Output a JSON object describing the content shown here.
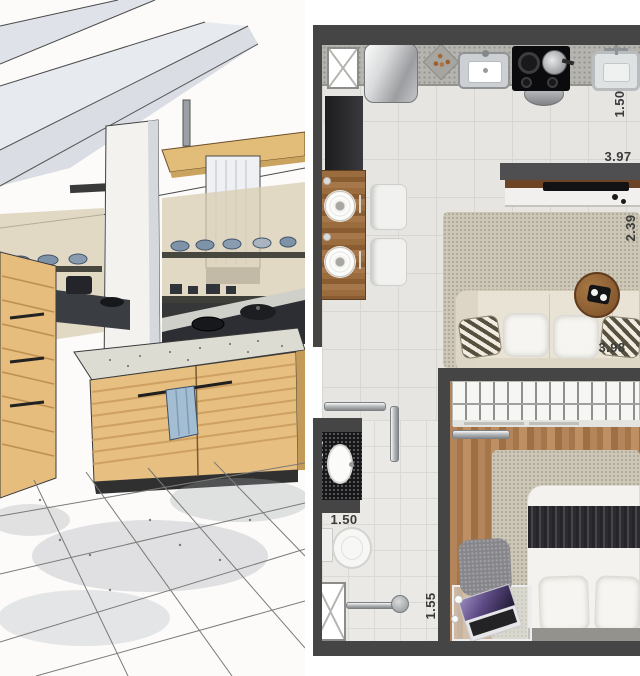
{
  "panels": {
    "left": "kitchen-interior-marker-sketch",
    "right": "studio-apartment-floor-plan-top-view"
  },
  "floor_plan": {
    "dimensions": {
      "kitchen_depth": "1.50",
      "living_width": "3.97",
      "living_depth": "2.39",
      "bedroom_width": "3.98",
      "bathroom_width": "1.50",
      "shower_width": "1.55"
    },
    "rooms": [
      "kitchen",
      "dining",
      "living",
      "hall",
      "bathroom",
      "bedroom"
    ],
    "objects": {
      "kitchen": [
        "ventilation-shaft",
        "refrigerator",
        "decor-dish",
        "sink",
        "cooktop",
        "service-sink",
        "hanging-pot"
      ],
      "dining": [
        "wood-counter-table",
        "place-settings",
        "white-chairs"
      ],
      "living": [
        "tv-panel",
        "media-console",
        "area-rug",
        "sofa",
        "striped-pillows",
        "round-side-table"
      ],
      "bathroom": [
        "granite-vanity",
        "oval-sink",
        "toilet",
        "shower-head",
        "ventilation-shaft"
      ],
      "bedroom": [
        "wardrobe-with-hangers",
        "double-bed",
        "pillows",
        "striped-runner",
        "area-rug",
        "glass-desk",
        "laptop",
        "desk-chair",
        "sliding-door"
      ]
    },
    "colors": {
      "wall": "#454545",
      "floor_tile": "#e6e5e2",
      "wood_floor": "#ad7c4e",
      "counter": "#b5b4ae",
      "rug": "#cdc7b7",
      "granite": "#17171a"
    }
  },
  "sketch": {
    "objects": [
      "ceiling-beams",
      "column",
      "range-hood",
      "open-shelves",
      "wood-cabinets",
      "kitchen-island",
      "hand-towel",
      "tiled-floor"
    ]
  }
}
